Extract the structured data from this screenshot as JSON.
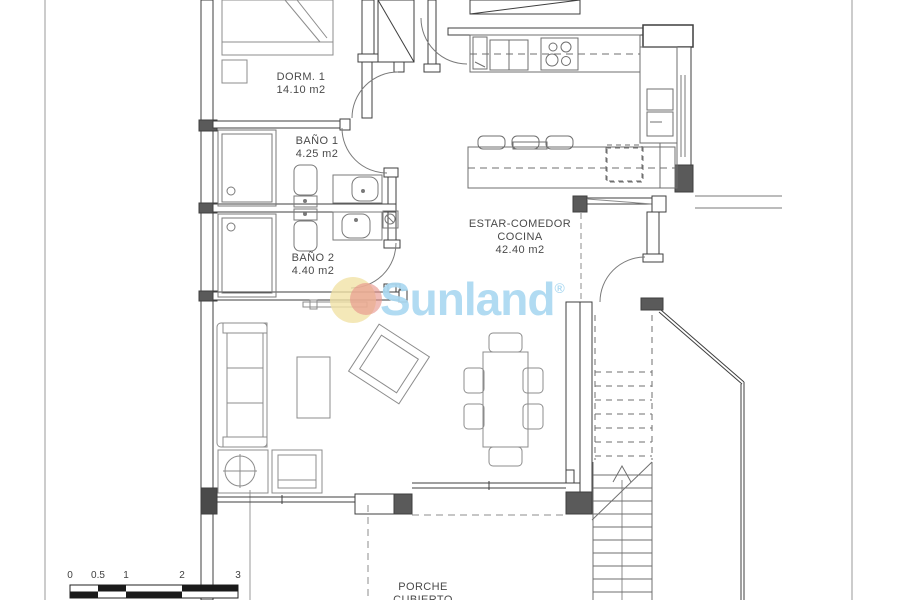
{
  "plan": {
    "rooms": {
      "dorm1": {
        "name": "DORM. 1",
        "area": "14.10 m2"
      },
      "bano1": {
        "name": "BAÑO 1",
        "area": "4.25 m2"
      },
      "bano2": {
        "name": "BAÑO 2",
        "area": "4.40 m2"
      },
      "estar": {
        "name_line1": "ESTAR-COMEDOR",
        "name_line2": "COCINA",
        "area": "42.40 m2"
      },
      "porche": {
        "name_line1": "PORCHE",
        "name_line2": "CUBIERTO"
      }
    },
    "scale_bar": {
      "labels": [
        "0",
        "0.5",
        "1",
        "2",
        "3"
      ]
    },
    "logo": {
      "text": "Sunland",
      "registered": "®"
    }
  },
  "colors": {
    "wall": "#3f3f3f",
    "line": "#6f6f6f",
    "furniture": "#8c8c8c",
    "logo_blue": "#abd9f1",
    "sun_yellow": "#f1e1a4",
    "sun_red": "#e6938b",
    "background": "#ffffff"
  }
}
